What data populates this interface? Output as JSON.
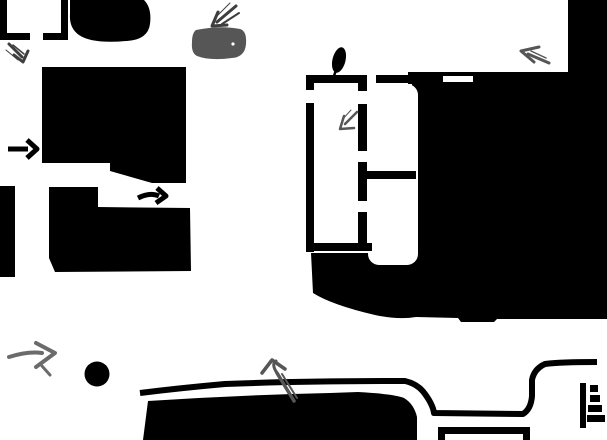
{
  "canvas": {
    "width_px": 607,
    "height_px": 440,
    "kind": "monochrome map / floor-plan scan with hand-drawn annotations",
    "text_content": "none"
  },
  "colors": {
    "background": "#ffffff",
    "ink": "#000000",
    "annotation_dark": "#3e3e3e",
    "annotation": "#565656",
    "annotation_light": "#6b6b6b"
  },
  "regions": [
    {
      "name": "corner-bracket-top-left",
      "shape": "L-corner outline"
    },
    {
      "name": "corner-bracket-top-left-2",
      "shape": "mirrored L-corner outline"
    },
    {
      "name": "blob-top",
      "shape": "rounded black blob at top edge"
    },
    {
      "name": "building-upper-left",
      "shape": "large black rectangle with notched lower-right"
    },
    {
      "name": "building-lower-left",
      "shape": "black stepped rectangle"
    },
    {
      "name": "edge-strip-left",
      "shape": "black strip on left edge"
    },
    {
      "name": "mass-right",
      "shape": "large black mass wrapping white floor-plan rooms"
    },
    {
      "name": "floor-plan",
      "shape": "white rooms with black walls, door gaps, divider"
    },
    {
      "name": "mass-bottom",
      "shape": "black mass along bottom edge"
    },
    {
      "name": "road-bottom",
      "shape": "thin black road outline with U-turn curve"
    },
    {
      "name": "box-bottom-right",
      "shape": "open rectangle outline clipped by bottom edge"
    }
  ],
  "markers": [
    {
      "name": "circle-marker",
      "shape": "filled black dot",
      "approx_center": [
        97,
        374
      ]
    },
    {
      "name": "stairs-marker",
      "shape": "vertical bar with 4 widening rungs",
      "area": "bottom right"
    },
    {
      "name": "flame-marker",
      "shape": "tilted black teardrop on top wall of floor plan"
    },
    {
      "name": "gray-blob-marker",
      "shape": "dark gray rounded rectangle",
      "area": "top center"
    }
  ],
  "arrows": [
    {
      "name": "arrow-black-left-1",
      "direction": "right",
      "color_ref": "ink"
    },
    {
      "name": "arrow-black-left-2",
      "direction": "right",
      "color_ref": "ink"
    },
    {
      "name": "arrow-gray-top-left",
      "direction": "down-right",
      "color_ref": "annotation_dark"
    },
    {
      "name": "arrow-gray-top-center",
      "direction": "down-left",
      "color_ref": "annotation_dark"
    },
    {
      "name": "arrow-gray-top-right",
      "direction": "up-left",
      "color_ref": "annotation"
    },
    {
      "name": "arrow-gray-floor-plan",
      "direction": "down-left",
      "color_ref": "annotation"
    },
    {
      "name": "arrow-gray-bottom-left",
      "direction": "right",
      "color_ref": "annotation_light"
    },
    {
      "name": "arrow-gray-road",
      "direction": "up",
      "color_ref": "annotation"
    }
  ]
}
